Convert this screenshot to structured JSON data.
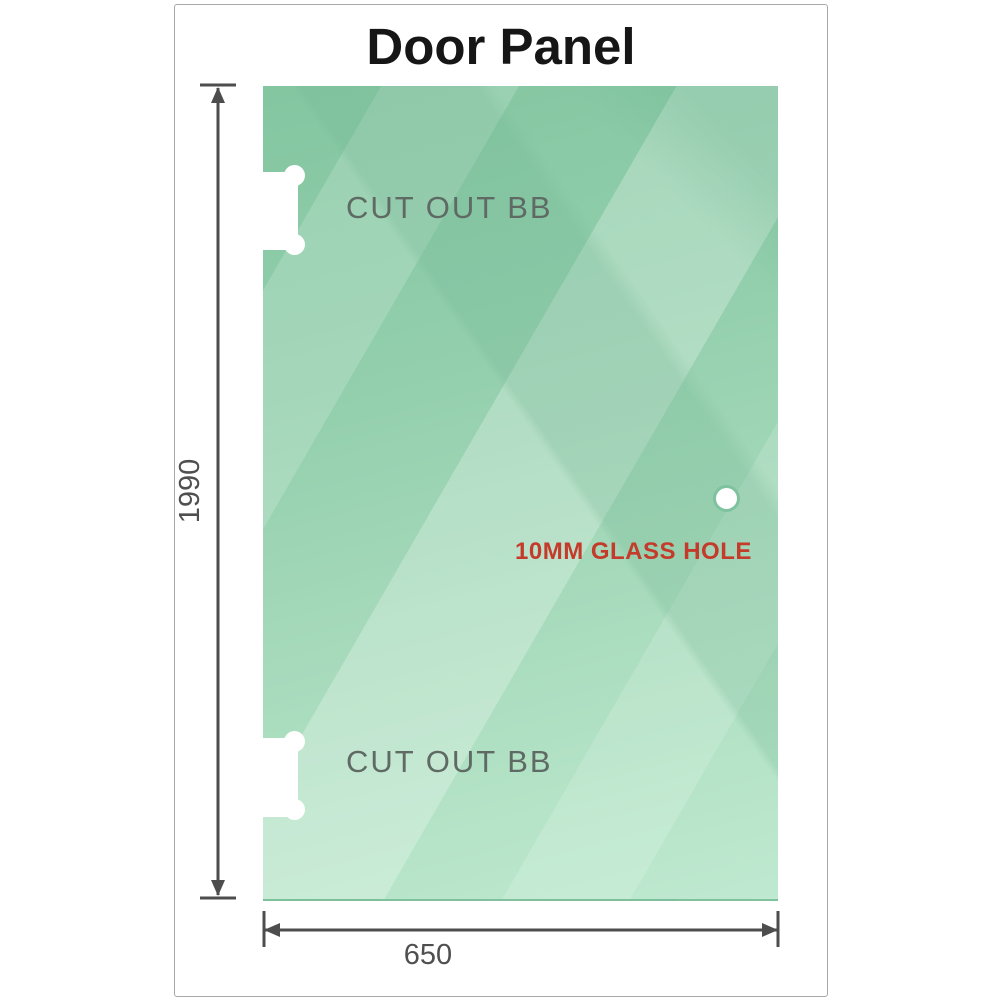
{
  "title": "Door Panel",
  "dimensions": {
    "height_label": "1990",
    "width_label": "650"
  },
  "panel": {
    "cutouts": [
      {
        "position": "top-left",
        "label": "CUT OUT BB"
      },
      {
        "position": "bottom-left",
        "label": "CUT OUT BB"
      }
    ],
    "hole": {
      "label": "10MM GLASS HOLE"
    }
  },
  "colors": {
    "glass_green_dark": "#83c6a0",
    "glass_green_light": "#bfe9d1",
    "hole_ring_green": "#7ec29f",
    "dimension_gray": "#4d4d4d",
    "dim_text_gray": "#4f4f4f",
    "cutout_label_gray": "#5f6a64",
    "hole_label_red": "#c43b2b",
    "title_black": "#161616",
    "frame_border_gray": "#a8a8a8"
  }
}
